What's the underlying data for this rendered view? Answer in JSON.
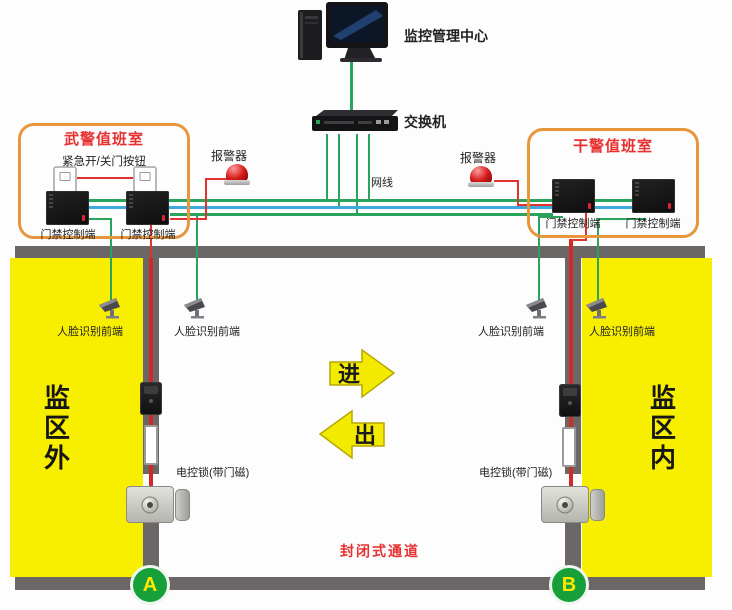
{
  "monitor_center": {
    "label": "监控管理中心"
  },
  "switch": {
    "label": "交换机"
  },
  "cable": {
    "label": "网线"
  },
  "left_room": {
    "title": "武警值班室",
    "emergency_button_label": "紧急开/关门按钮",
    "controller_left_label": "门禁控制端",
    "controller_right_label": "门禁控制端"
  },
  "right_room": {
    "title": "干警值班室",
    "controller_left_label": "门禁控制端",
    "controller_right_label": "门禁控制端"
  },
  "alarms": {
    "left_label": "报警器",
    "right_label": "报警器"
  },
  "cameras": {
    "left_outer_label": "人脸识别前端",
    "left_inner_label": "人脸识别前端",
    "right_inner_label": "人脸识别前端",
    "right_outer_label": "人脸识别前端"
  },
  "locks": {
    "left_label": "电控锁(带门磁)",
    "right_label": "电控锁(带门磁)"
  },
  "zones": {
    "outside_label": "监区外",
    "inside_label": "监区内",
    "passage_label": "封闭式通道"
  },
  "flow_arrows": {
    "enter": "进",
    "exit": "出"
  },
  "gates": {
    "a": "A",
    "b": "B"
  },
  "colors": {
    "zone_yellow": "#f8ee00",
    "wall_gray": "#6b6767",
    "wire_green": "#2aa45c",
    "wire_blue": "#3fa8dc",
    "wire_red": "#e0332e",
    "room_border_orange": "#e8963c",
    "title_red": "#e83030",
    "gate_green": "#17a03a",
    "arrow_yellow": "#f2ea00"
  }
}
